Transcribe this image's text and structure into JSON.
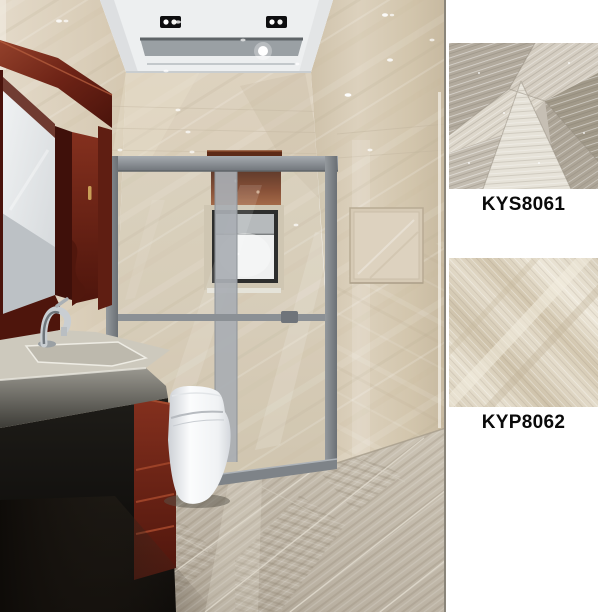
{
  "page": {
    "background": "#ffffff"
  },
  "samples": [
    {
      "code": "KYS8061",
      "style": "grey patchwork stone tile swatch"
    },
    {
      "code": "KYP8062",
      "style": "beige diagonal-vein stone tile swatch"
    }
  ],
  "scene": {
    "type": "bathroom-interior-render",
    "colors": {
      "wall_tile": "#d9cdb9",
      "floor_tile": "#b5ac9d",
      "ceiling": "#edeff0",
      "shower_frame": "#82878c",
      "vanity_wood": "#6d2518",
      "window_valance": "#7c3d22",
      "sanitary_white": "#f4f5f6"
    }
  }
}
